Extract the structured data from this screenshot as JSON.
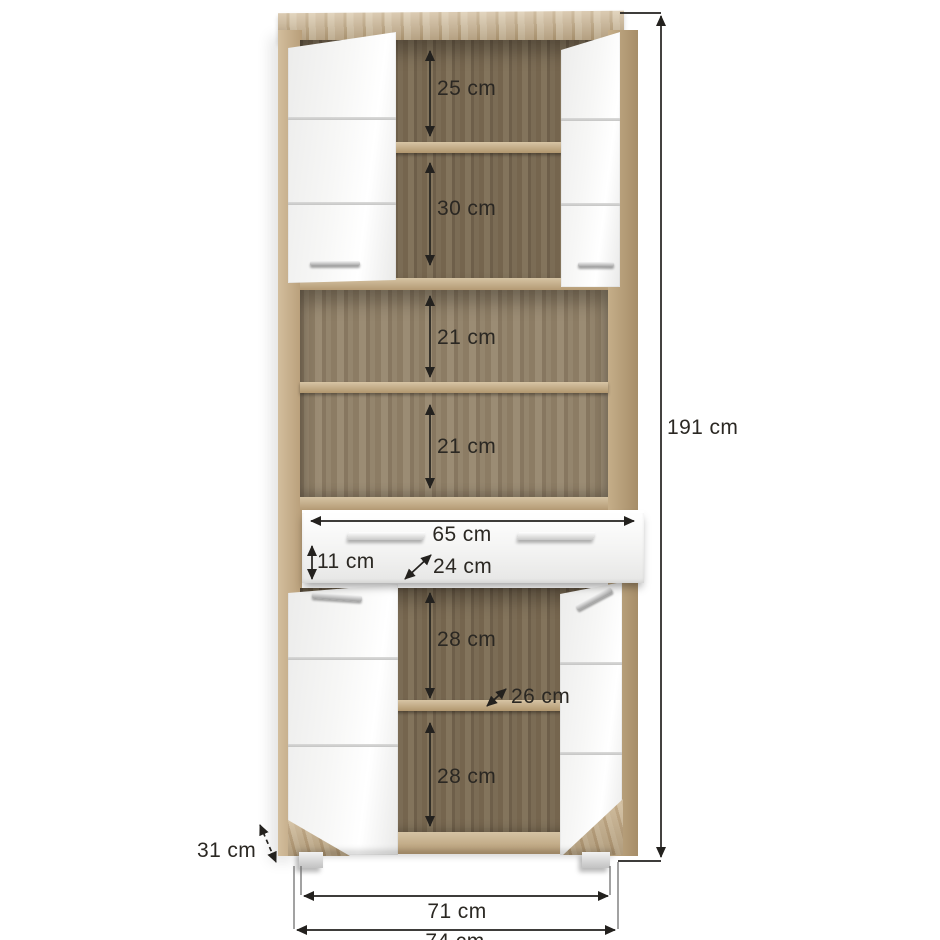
{
  "diagram": {
    "name": "tall cabinet dimension diagram",
    "unit": "cm",
    "labels": {
      "top_compartment_height": "25 cm",
      "second_compartment_height": "30 cm",
      "open_shelf_upper_height": "21 cm",
      "open_shelf_lower_height": "21 cm",
      "drawer_width": "65 cm",
      "drawer_front_height": "11 cm",
      "drawer_depth": "24 cm",
      "lower_compartment_upper_height": "28 cm",
      "lower_shelf_depth": "26 cm",
      "lower_compartment_lower_height": "28 cm",
      "overall_height": "191 cm",
      "side_depth": "31 cm",
      "feet_span_width": "71 cm",
      "overall_width": "74 cm"
    },
    "colors": {
      "oak_light": "#c8b18d",
      "oak_dark_back": "#73644d",
      "oak_mid_back": "#8d7e66",
      "door_white": "#f5f5f4",
      "dimension_line": "#23211e",
      "witness_line": "#6f6f6f",
      "label_text": "#2b2823",
      "background": "#ffffff"
    }
  }
}
